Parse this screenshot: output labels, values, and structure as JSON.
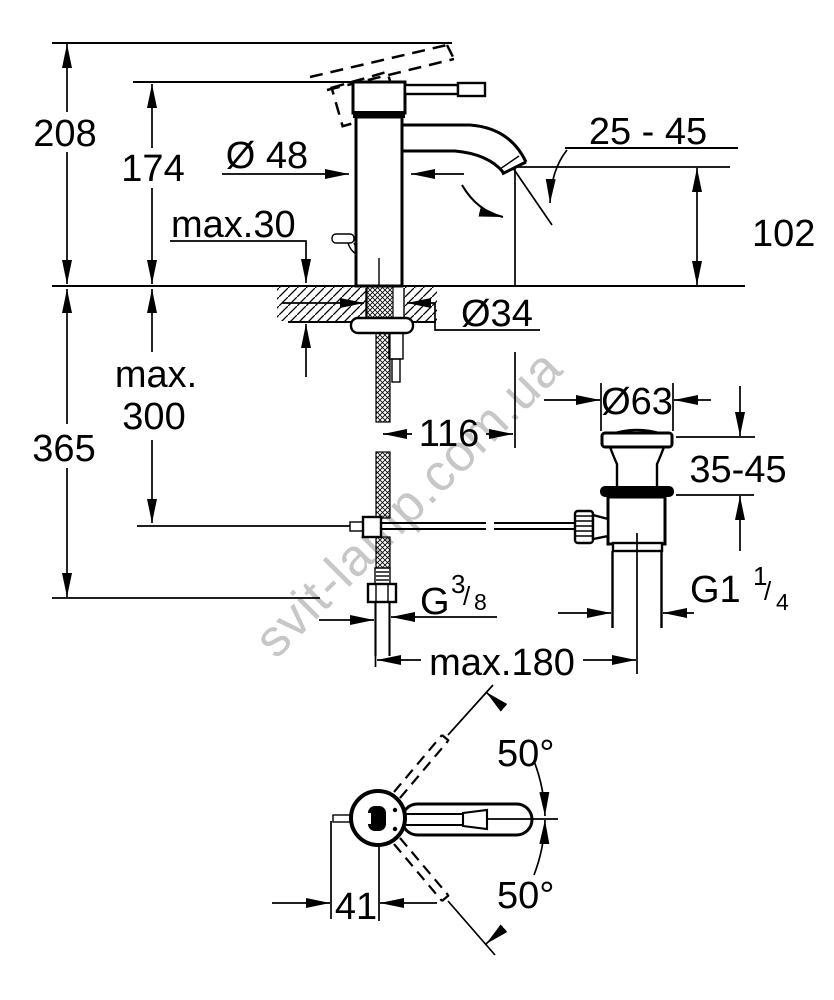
{
  "drawing": {
    "type": "technical-dimension-drawing",
    "subject": "single-lever basin mixer with pop-up waste",
    "colors": {
      "line": "#000000",
      "background": "#ffffff",
      "watermark": "#c7c7c7"
    },
    "watermark": {
      "text": "svit-lamp.com.ua"
    },
    "dims": {
      "overall_height": "208",
      "lever_height": "174",
      "body_diameter": "Ø 48",
      "deck_thickness": "max.30",
      "aerator_range": "25 - 45",
      "spout_height": "102",
      "hole_diameter": "Ø34",
      "spout_reach": "116",
      "hose_depth_line1": "max.",
      "hose_depth_line2": "300",
      "install_depth": "365",
      "waste_cap_diameter": "Ø63",
      "waste_clamp_range": "35-45",
      "center_distance": "max.180",
      "handle_length": "41",
      "swivel_angle_upper": "50°",
      "swivel_angle_lower": "50°",
      "supply_thread": {
        "base": "G",
        "numerator": "3",
        "slash": "/",
        "denominator": "8"
      },
      "waste_thread": {
        "base": "G1",
        "numerator": "1",
        "slash": "/",
        "denominator": "4"
      }
    }
  }
}
